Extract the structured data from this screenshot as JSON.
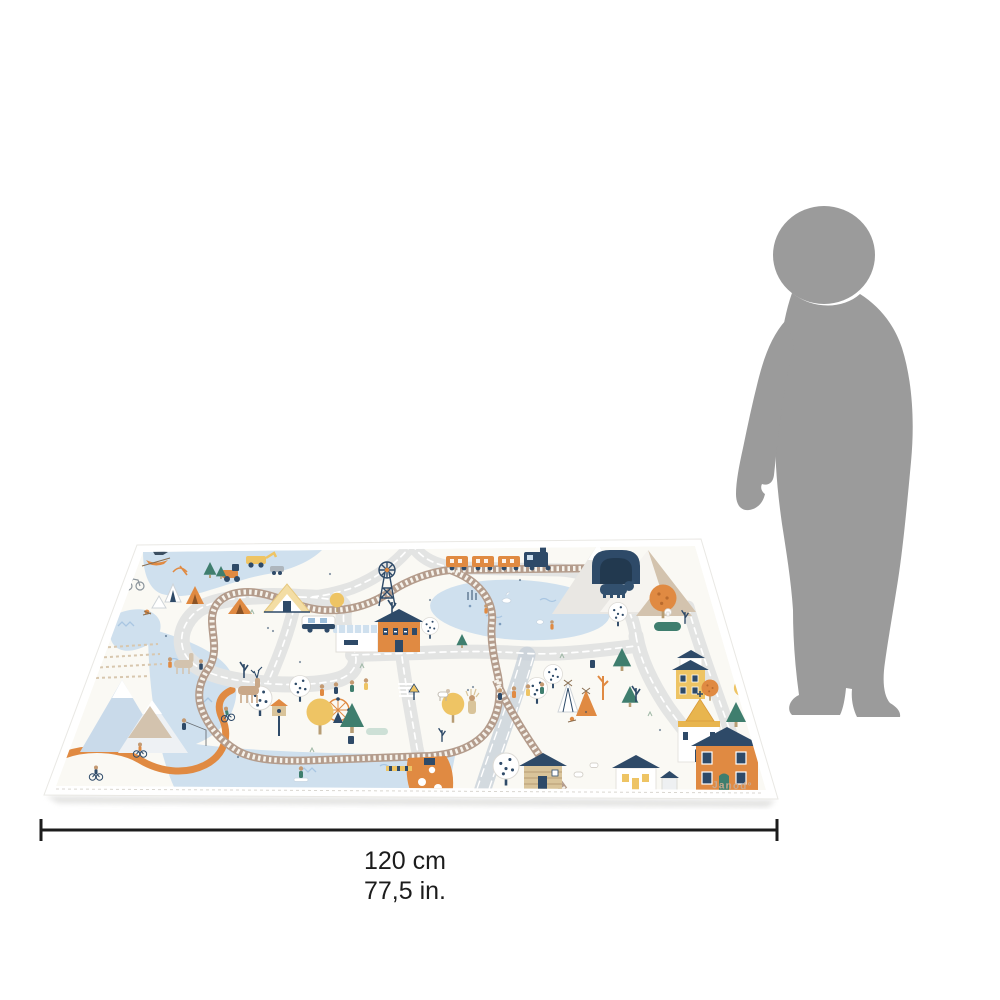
{
  "product": {
    "brand": "Janod°",
    "description_elements": [
      "toy-town-playmat",
      "child-silhouette",
      "road-circuit",
      "railway-loop",
      "train",
      "train-tunnel",
      "lake",
      "pond",
      "river",
      "mountains",
      "station-house",
      "chalet",
      "windmill",
      "church",
      "houses",
      "log-cabin",
      "harbor-pier",
      "teepees",
      "campsite",
      "ferris-wheel",
      "bear",
      "deer",
      "cyclists",
      "fisherman",
      "hikers",
      "trees"
    ]
  },
  "dimension": {
    "width_cm": "120 cm",
    "width_in": "77,5 in."
  },
  "colors": {
    "background": "#ffffff",
    "silhouette": "#9b9b9b",
    "dimension_line": "#1c1c1c",
    "text": "#1c1c1c",
    "mat_base": "#faf9f4",
    "mat_hem": "#ffffff",
    "road": "#e3e4e3",
    "road_marking": "#ffffff",
    "track": "#b49c8c",
    "track_tie": "#f6f3ec",
    "water": "#cfe0ee",
    "water_detail": "#a9c6e2",
    "orange": "#e08a42",
    "navy": "#2e4a68",
    "teal": "#3f7e6e",
    "yellow": "#eec464",
    "beige": "#d3c3ae",
    "wood": "#d9c49a",
    "brand_text": "#c9a98e"
  }
}
